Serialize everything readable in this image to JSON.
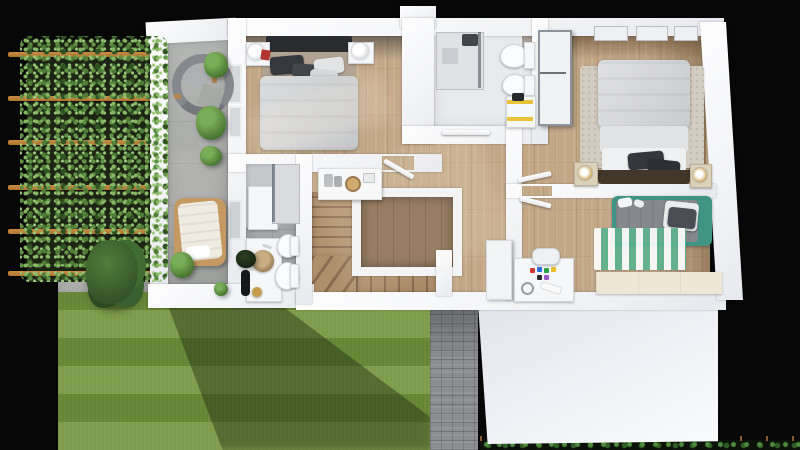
{
  "scene": {
    "type": "3d-floor-plan-render",
    "view": "top-down-dollhouse",
    "level": "upper-floor-with-garden-and-garage-roof"
  },
  "palette": {
    "blackBg": "#070708",
    "wall": "#f3f4f6",
    "wood": "#c3a888",
    "woodDark": "#8a6e52",
    "terrace": "#a7a9a7",
    "tile": "#a4a7a9",
    "bathLight": "#e9eaec",
    "lawn": "#74953f",
    "leaf": "#5f8f43",
    "beam": "#b0762f",
    "paver": "#8b8d90",
    "roof": "#edeff4",
    "hedge": "#2f5e24",
    "duvet": "#cfd1d3",
    "pillowDark": "#35383d",
    "headboard": "#2b2c30",
    "teal": "#3f9483",
    "rug": "#d2ccc1",
    "rugStripe": "#5db28f",
    "gold": "#c79c4e",
    "yellow": "#e8c23a",
    "cream": "#efe7d5"
  },
  "outdoor": {
    "pergola": {
      "structure": "wood-beam-trellis",
      "beams": 6,
      "planting": "climbing-vines"
    },
    "terrace": {
      "floor": "concrete",
      "furniture": [
        "curved-lounge-chair",
        "sun-lounger",
        "potted-plants"
      ]
    },
    "garden": {
      "lawn": "striped-mowed",
      "tree": 1,
      "paver-path": true,
      "hedge-row-with-stakes": true
    },
    "garage": {
      "roof": "flat-white"
    }
  },
  "rooms": [
    {
      "name": "master-bedroom",
      "floor": "oak",
      "furniture": [
        "double-bed",
        "dark-headboard",
        "nightstand-left",
        "nightstand-right",
        "globe-lamps",
        "red-books",
        "two-windows"
      ]
    },
    {
      "name": "bathroom-top",
      "floor": "light",
      "furniture": [
        "walk-in-shower",
        "toilet",
        "bidet",
        "water-heater-yellow-strap"
      ]
    },
    {
      "name": "bedroom-right",
      "floor": "oak",
      "furniture": [
        "double-bed",
        "speckled-rug",
        "tall-wardrobe",
        "nightstand-left",
        "nightstand-right",
        "gold-lamps",
        "skylights"
      ]
    },
    {
      "name": "kids-room",
      "floor": "oak",
      "furniture": [
        "single-bed-teal-frame",
        "green-striped-rug",
        "desk-with-markers",
        "chair",
        "cream-sideboard",
        "closet"
      ]
    },
    {
      "name": "bathroom-left",
      "floor": "gray-tile",
      "furniture": [
        "shower",
        "toilet",
        "bidet",
        "round-basin-vanity",
        "mirror-cabinet",
        "black-planter",
        "gold-stool"
      ]
    },
    {
      "name": "hallway",
      "floor": "oak",
      "furniture": [
        "console-shelf-with-jars",
        "open-doors"
      ]
    },
    {
      "name": "staircase",
      "features": [
        "u-shaped-flights",
        "winder-steps",
        "stairwell-void-with-white-balustrade"
      ]
    }
  ]
}
